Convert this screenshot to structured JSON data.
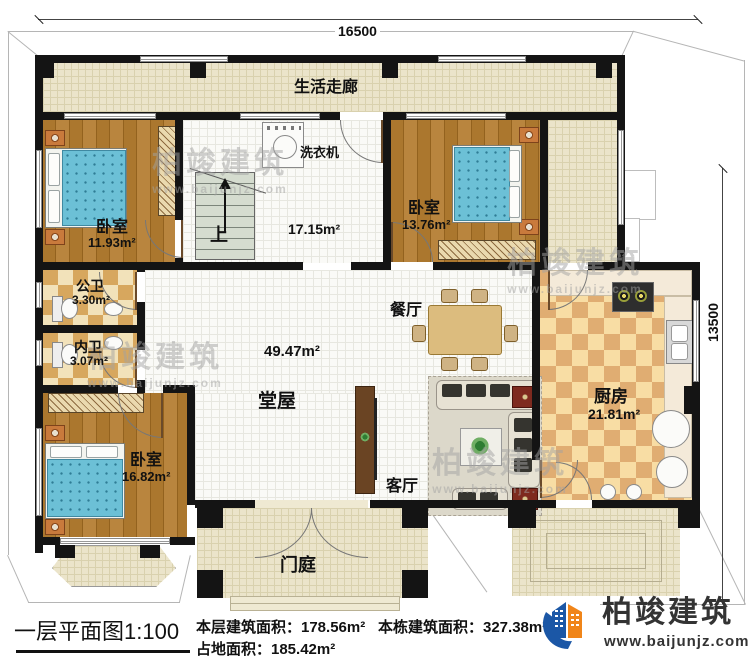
{
  "plan": {
    "dimension_top": "16500",
    "dimension_right": "13500",
    "rooms": {
      "corridor": {
        "label": "生活走廊"
      },
      "stair_hall": {
        "area": "17.15m²",
        "up": "上",
        "appliance": "洗衣机"
      },
      "bedroom_left": {
        "label": "卧室",
        "area": "11.93m²"
      },
      "bedroom_right": {
        "label": "卧室",
        "area": "13.76m²"
      },
      "bedroom_bottom": {
        "label": "卧室",
        "area": "16.82m²"
      },
      "bath_public": {
        "label": "公卫",
        "area": "3.30m²"
      },
      "bath_private": {
        "label": "内卫",
        "area": "3.07m²"
      },
      "hall": {
        "label": "堂屋",
        "area": "49.47m²"
      },
      "dining": {
        "label": "餐厅"
      },
      "living": {
        "label": "客厅"
      },
      "kitchen": {
        "label": "厨房",
        "area": "21.81m²"
      },
      "porch": {
        "label": "门庭"
      }
    }
  },
  "watermark": {
    "name": "柏竣建筑",
    "site": "www.baijunjz.com"
  },
  "footer": {
    "title": "一层平面图1:100",
    "floor_area": "本层建筑面积：178.56m²",
    "building_area": "本栋建筑面积：327.38m²",
    "land_area": "占地面积：185.42m²"
  },
  "logo": {
    "name": "柏竣建筑",
    "site": "www.baijunjz.com"
  },
  "colors": {
    "wall": "#141414",
    "wood_floor": "#a9762e",
    "bed": "#6cc0d6",
    "corridor_tile": "#ebe4ca",
    "bath_checker": "#d7a75e",
    "kitchen_checker": "#e0ad72",
    "logo_blue": "#1b57a6",
    "logo_orange": "#f08519"
  }
}
